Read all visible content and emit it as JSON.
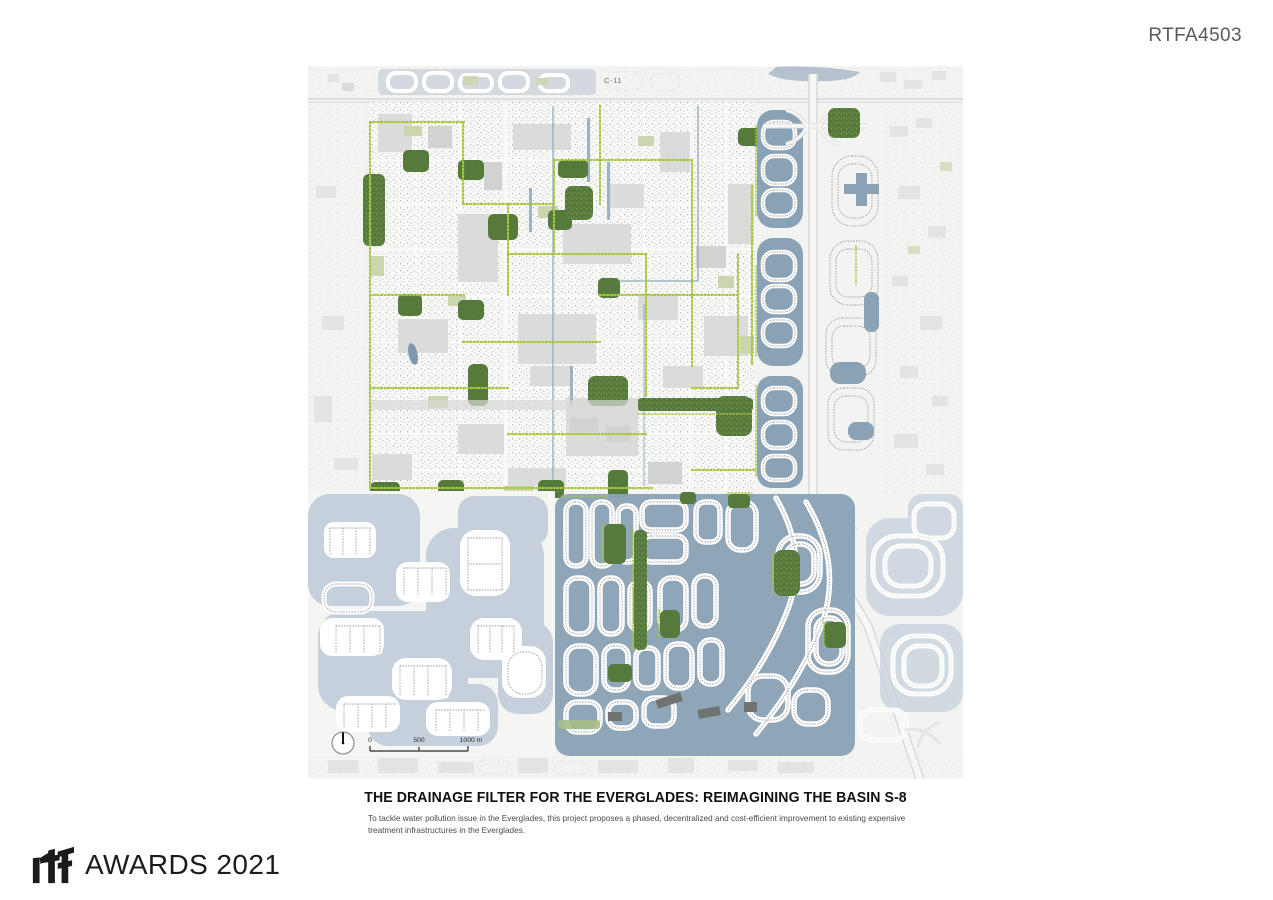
{
  "page": {
    "code": "RTFA4503"
  },
  "map": {
    "canal_label": "C-11",
    "scale": {
      "t0": "0",
      "t500": "500",
      "t1000": "1000 m"
    }
  },
  "caption": {
    "title": "THE DRAINAGE FILTER FOR THE EVERGLADES: REIMAGINING THE BASIN S-8",
    "description": "To tackle water pollution issue in the Everglades, this project proposes a phased, decentralized and cost-efficient improvement to existing expensive treatment infrastructures in the Everglades."
  },
  "footer": {
    "logo_text": "rtf",
    "awards_text": "AWARDS 2021"
  },
  "colors": {
    "page-bg": "#ffffff",
    "map-bg": "#f3f3f1",
    "block-gray": "#dbdcda",
    "house-dot": "#9b9c9a",
    "green-dark": "#567a3b",
    "green-foliage": "#7fa25c",
    "chartreuse": "#a6c73d",
    "sage": "#ccd6ae",
    "sage-dark": "#a9bd85",
    "water-med": "#8aa2b6",
    "water-pale": "#c6d0dc",
    "canal": "#8fa9bd",
    "canal-band": "#b5c1ce",
    "road-casing": "#dcddda",
    "road-fill": "#f7f7f5",
    "ink": "#111111",
    "text-gray": "#4a4a4a",
    "code-gray": "#595a5c",
    "logo-ink": "#1d1a1c"
  }
}
